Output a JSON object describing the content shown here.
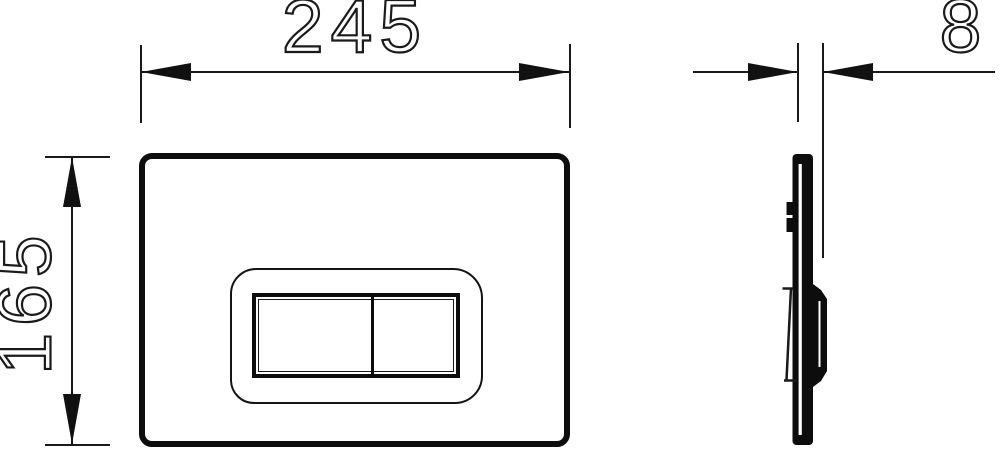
{
  "dimensions": {
    "width": {
      "value": "245"
    },
    "height": {
      "value": "165"
    },
    "depth": {
      "value": "8"
    }
  },
  "colors": {
    "line": "#1a1a1a",
    "fill": "#0d0d0d",
    "background": "#ffffff"
  }
}
